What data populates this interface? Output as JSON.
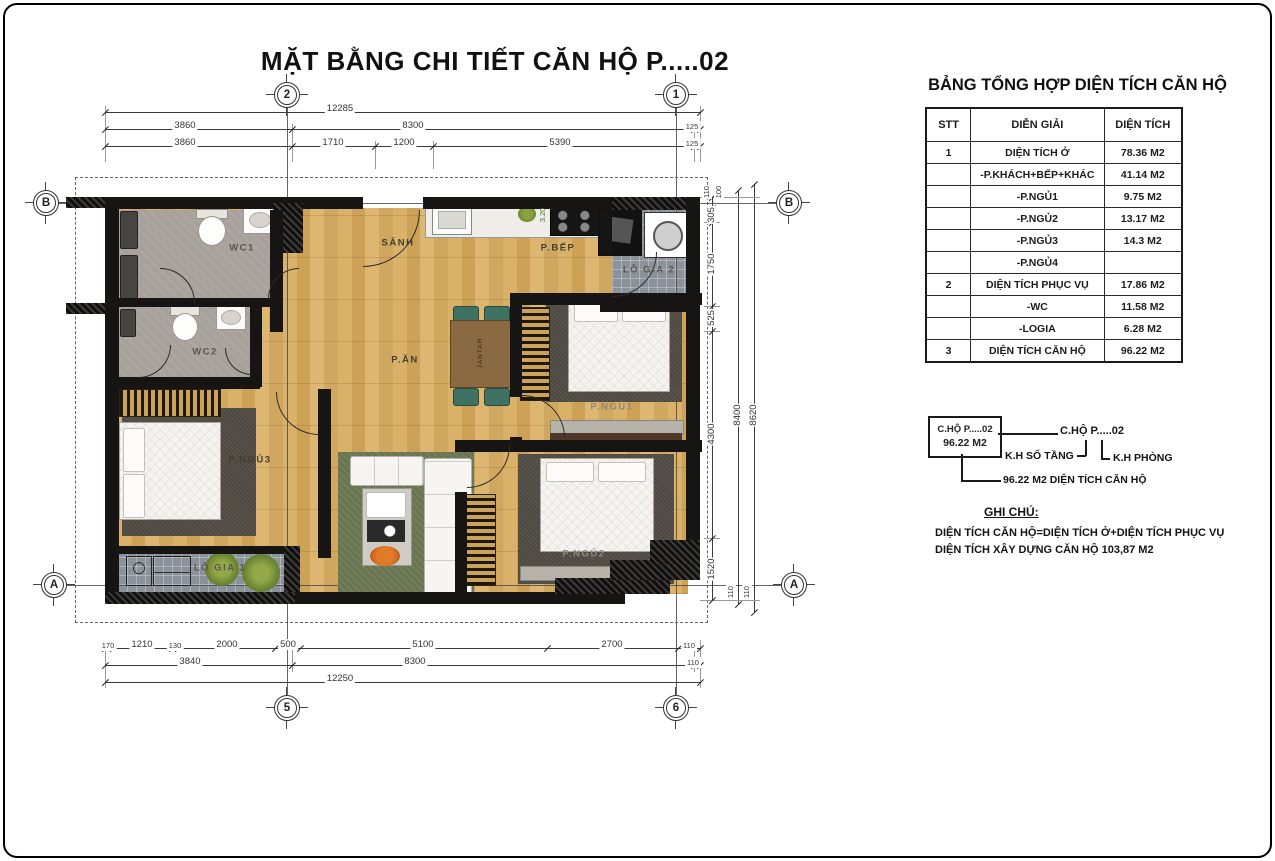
{
  "title": "MẶT BẰNG CHI TIẾT CĂN HỘ  P.....02",
  "plan": {
    "rooms": {
      "wc1": "WC1",
      "wc2": "WC2",
      "sanh": "SẢNH",
      "pbep": "P.BẾP",
      "logia2": "LÔ GIA 2",
      "pan": "P.ĂN",
      "pngu1": "P.NGỦ1",
      "pngu2": "P.NGỦ2",
      "pngu3": "P.NGỦ3",
      "logia1": "LÔ GIA 1",
      "table_text": "JANTAR",
      "kitchen_note": "3.20"
    },
    "grid_bubbles": {
      "top_left": "2",
      "top_right": "1",
      "bottom_left": "5",
      "bottom_right": "6",
      "left_top": "B",
      "left_bottom": "A",
      "right_top": "B",
      "right_bottom": "A"
    },
    "dims": {
      "top_row1": [
        "12285"
      ],
      "top_row2": [
        "3860",
        "8300",
        "125"
      ],
      "top_row3": [
        "3860",
        "1710",
        "1200",
        "5390",
        "125"
      ],
      "bottom_row1": [
        "170",
        "1210",
        "130",
        "2000",
        "500",
        "5100",
        "2700",
        "110"
      ],
      "bottom_row2": [
        "3840",
        "8300",
        "110"
      ],
      "bottom_row3": [
        "12250"
      ],
      "right_col": [
        "110",
        "100",
        "305",
        "1750",
        "525",
        "4300",
        "1520",
        "110",
        "110"
      ],
      "right_total1": "8400",
      "right_total2": "8620"
    }
  },
  "panel": {
    "table_title": "BẢNG TỔNG HỢP DIỆN TÍCH CĂN HỘ",
    "table": {
      "headers": [
        "STT",
        "DIỄN GIẢI",
        "DIỆN TÍCH"
      ],
      "rows": [
        {
          "stt": "1",
          "label": "DIỆN TÍCH Ở",
          "value": "78.36 M2"
        },
        {
          "stt": "",
          "label": "-P.KHÁCH+BẾP+KHÁC",
          "value": "41.14 M2"
        },
        {
          "stt": "",
          "label": "-P.NGỦ1",
          "value": "9.75 M2"
        },
        {
          "stt": "",
          "label": "-P.NGỦ2",
          "value": "13.17 M2"
        },
        {
          "stt": "",
          "label": "-P.NGỦ3",
          "value": "14.3 M2"
        },
        {
          "stt": "",
          "label": "-P.NGỦ4",
          "value": ""
        },
        {
          "stt": "2",
          "label": "DIỆN TÍCH PHỤC VỤ",
          "value": "17.86 M2"
        },
        {
          "stt": "",
          "label": "-WC",
          "value": "11.58 M2"
        },
        {
          "stt": "",
          "label": "-LOGIA",
          "value": "6.28 M2"
        },
        {
          "stt": "3",
          "label": "DIỆN TÍCH CĂN HỘ",
          "value": "96.22 M2"
        }
      ]
    },
    "legend": {
      "box_line1": "C.HỘ P.....02",
      "box_line2": "96.22 M2",
      "callout": "C.HỘ P.....02",
      "floor_label": "K.H SỐ TẦNG",
      "room_label": "K.H PHÒNG",
      "area_note": "96.22 M2 DIỆN TÍCH CĂN HỘ"
    },
    "notes": {
      "heading": "GHI CHÚ:",
      "line1": "DIỆN TÍCH CĂN HỘ=DIỆN TÍCH Ở+DIỆN TÍCH PHỤC VỤ",
      "line2": "DIỆN TÍCH XÂY DỰNG CĂN HỘ 103,87 M2"
    }
  },
  "colors": {
    "wall": "#171513",
    "wood_floor": "#d2a95e",
    "wc_floor": "#a7a19a",
    "tile_floor": "#8c9299",
    "rug_dark": "#57524a",
    "rug_green": "#707d58",
    "plant_green": "#6d8733",
    "chair_green": "#3f7263"
  }
}
